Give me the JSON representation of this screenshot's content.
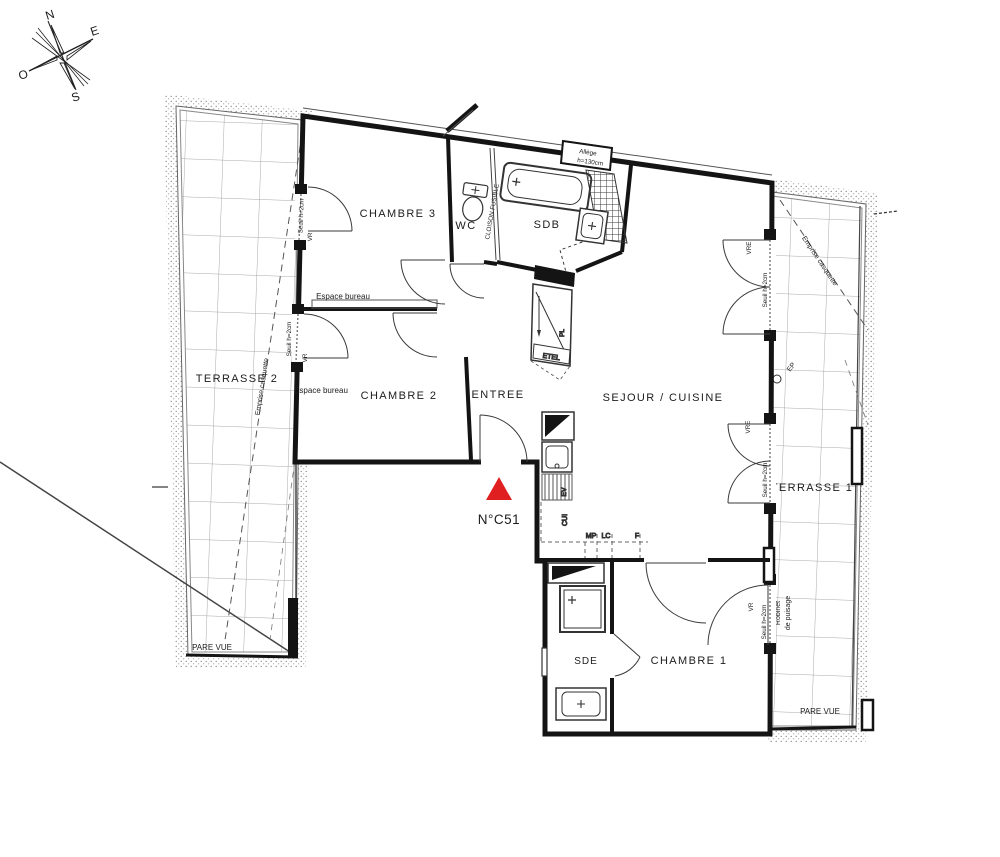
{
  "unit": {
    "number": "N°C51"
  },
  "compass": {
    "north": "N",
    "east": "E",
    "south": "S",
    "west": "O"
  },
  "rooms": {
    "terrasse2": "TERRASSE 2",
    "chambre3": "CHAMBRE 3",
    "wc": "WC",
    "sdb": "SDB",
    "chambre2": "CHAMBRE 2",
    "entree": "ENTREE",
    "sejour_cuisine": "SEJOUR / CUISINE",
    "terrasse1": "TERRASSE 1",
    "sde": "SDE",
    "chambre1": "CHAMBRE 1"
  },
  "labels": {
    "espace_bureau": "Espace bureau",
    "cloison_fusible": "CLOISON FUSIBLE",
    "allege_line1": "Allège",
    "allege_line2": "h=130cm",
    "seuil": "Seuil h=2cm",
    "vr": "VR",
    "vre": "VRE",
    "ep": "EP",
    "etel": "ETEL",
    "pl": "PL",
    "ev": "EV",
    "cui": "CUI",
    "mp": "MP",
    "lc": "LC",
    "f": "F",
    "emprise_casquette": "Emprise casquette",
    "pare_vue": "PARE VUE",
    "robinet_line1": "Robinet",
    "robinet_line2": "de puisage"
  },
  "colors": {
    "entry_marker": "#e02020",
    "wall": "#141414",
    "tile_line": "#9a9a9a"
  }
}
